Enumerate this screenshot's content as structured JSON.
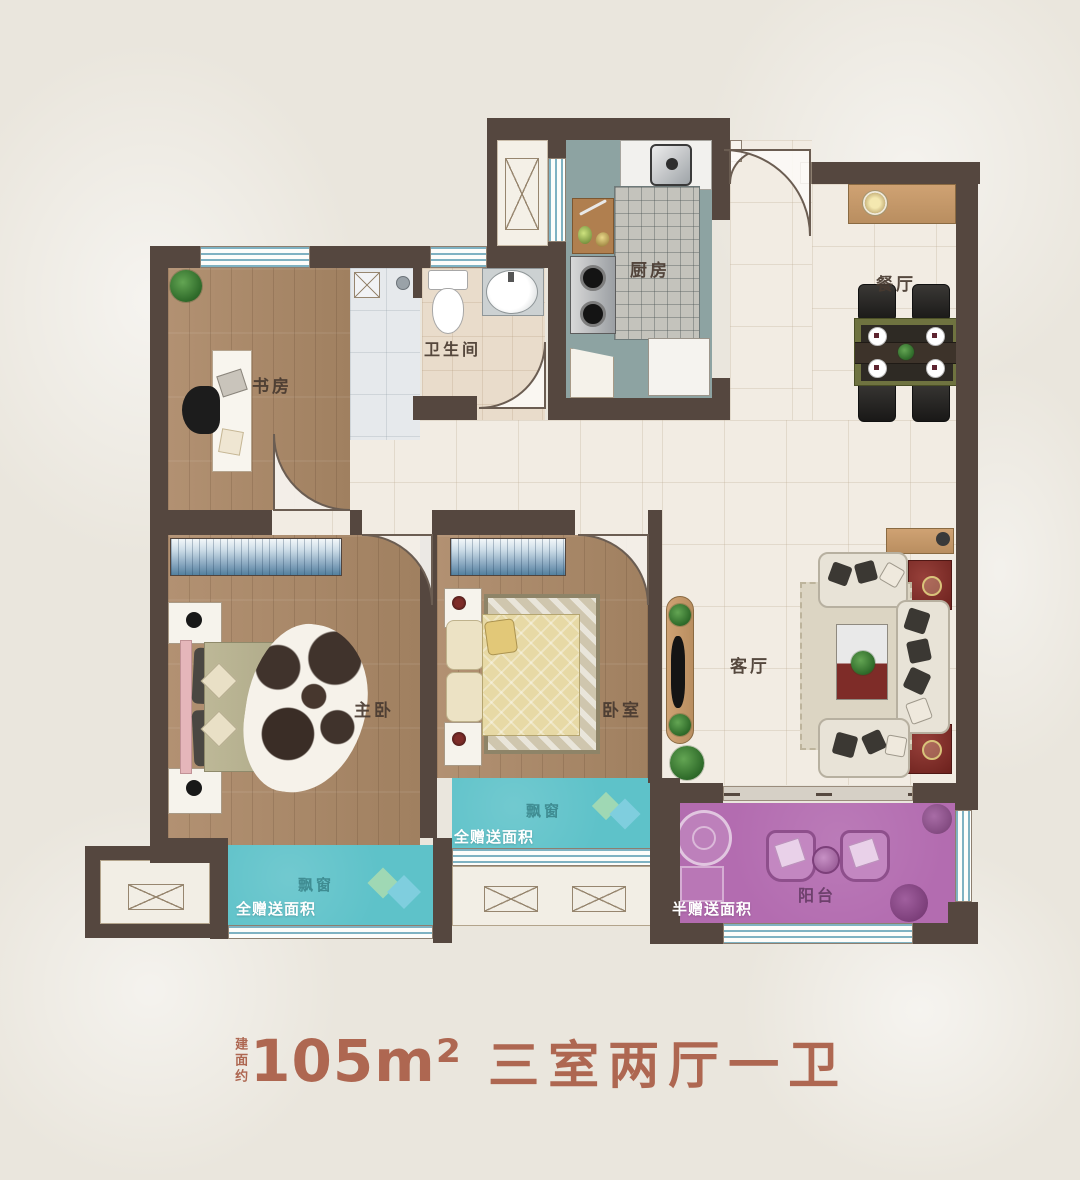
{
  "title": {
    "prefix": "建面约",
    "area": "105m²",
    "layout": "三室两厅一卫"
  },
  "rooms": {
    "study": "书房",
    "bathroom": "卫生间",
    "kitchen": "厨房",
    "dining": "餐厅",
    "master": "主卧",
    "bedroom2": "卧室",
    "living": "客厅",
    "balcony": "阳台"
  },
  "bays": {
    "bay_label": "飘窗",
    "gift_full": "全赠送面积",
    "gift_half": "半赠送面积"
  },
  "colors": {
    "wall": "#55473f",
    "bay_window": "#5ec2c9",
    "balcony": "#b36cb0",
    "wood_floor": "#ab8a6c",
    "tile_floor": "#f2ece3",
    "kitchen_floor": "#8da3a2",
    "title_text": "#ae6751"
  }
}
